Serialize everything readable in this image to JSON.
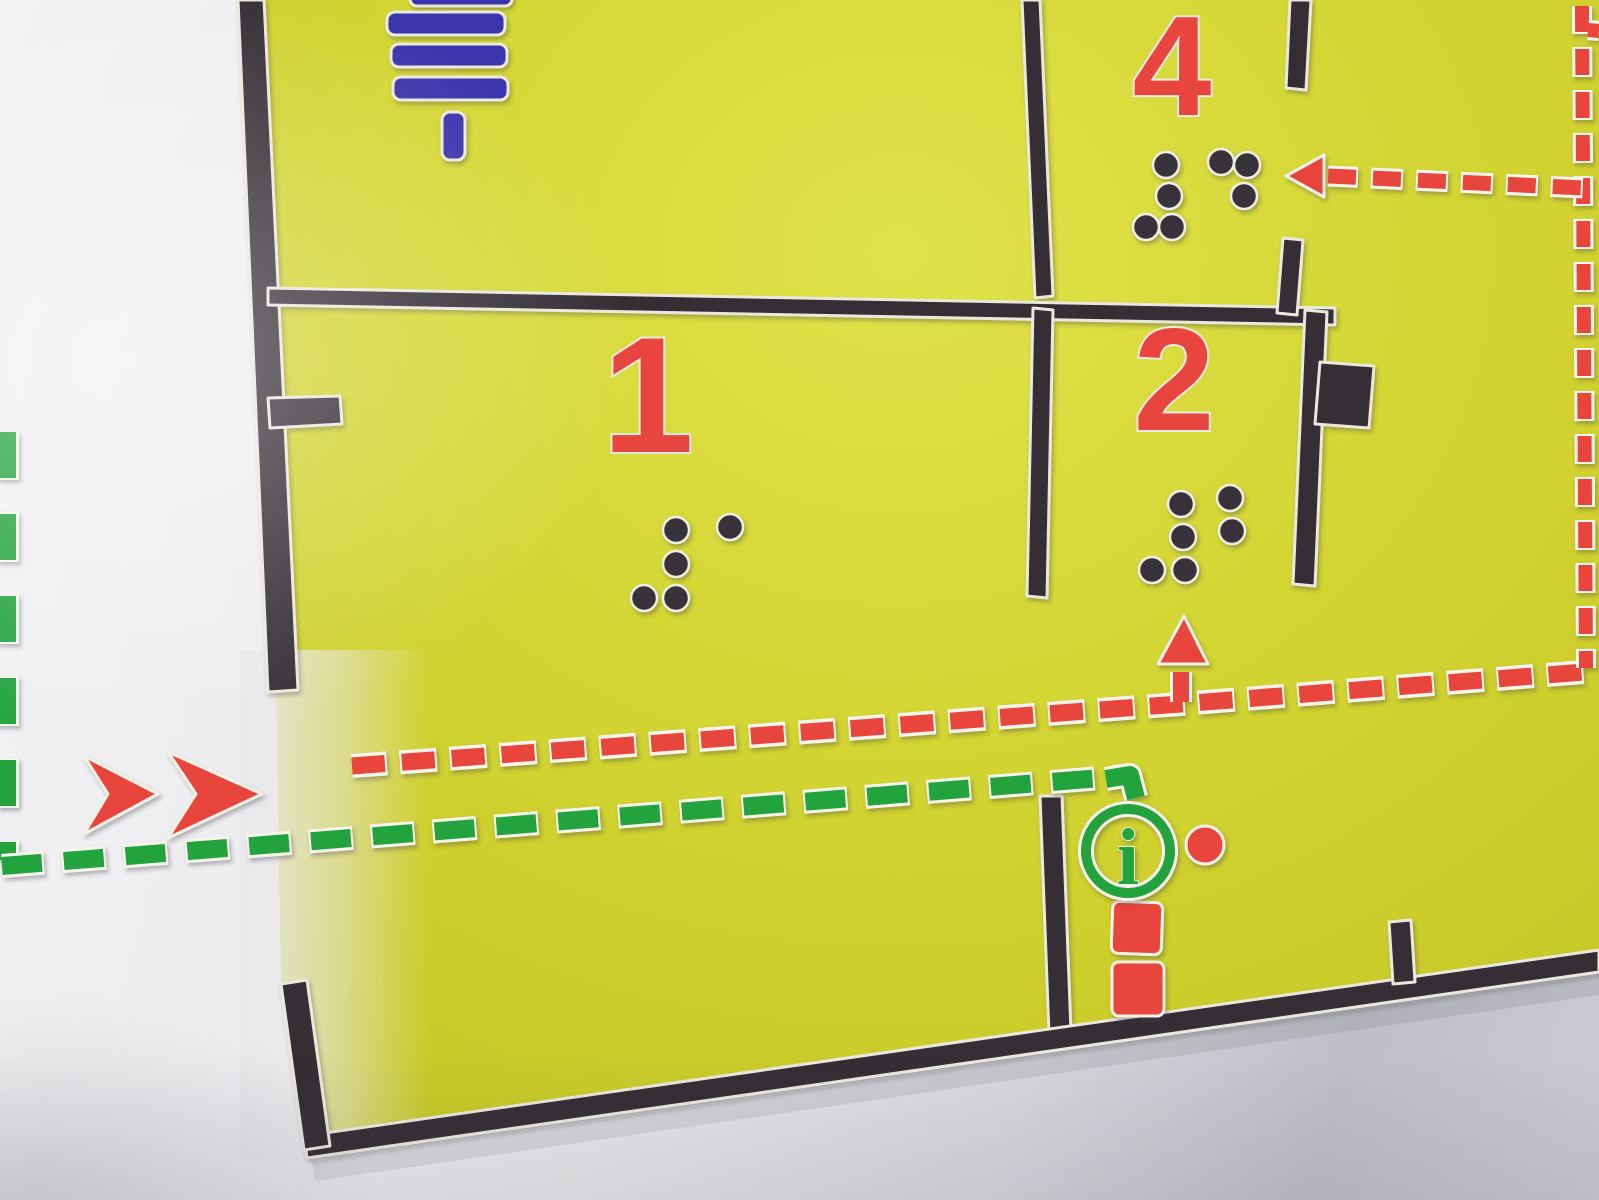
{
  "map": {
    "rooms": [
      {
        "number": "1",
        "braille": "⠼⠁"
      },
      {
        "number": "2",
        "braille": "⠼⠃"
      },
      {
        "number": "4",
        "braille": "⠼⠙"
      }
    ],
    "info_symbol": {
      "label": "i"
    },
    "icons": {
      "blue_bars": "stairs-symbol-icon",
      "green_circle": "info-icon",
      "red_dot": "location-dot-icon",
      "red_squares": "route-marker-icon",
      "red_double_chevron": "entrance-arrows-icon",
      "red_dashed_line": "escape-route-red-line",
      "green_dashed_line": "accessible-route-green-line"
    },
    "colors": {
      "background_white": "#e9e9ec",
      "floor_yellow": "#d3d532",
      "wall_black": "#342e36",
      "route_red": "#e8453e",
      "route_green": "#21a33d",
      "symbol_blue": "#3c35ad",
      "braille_dark": "#38323a"
    }
  }
}
